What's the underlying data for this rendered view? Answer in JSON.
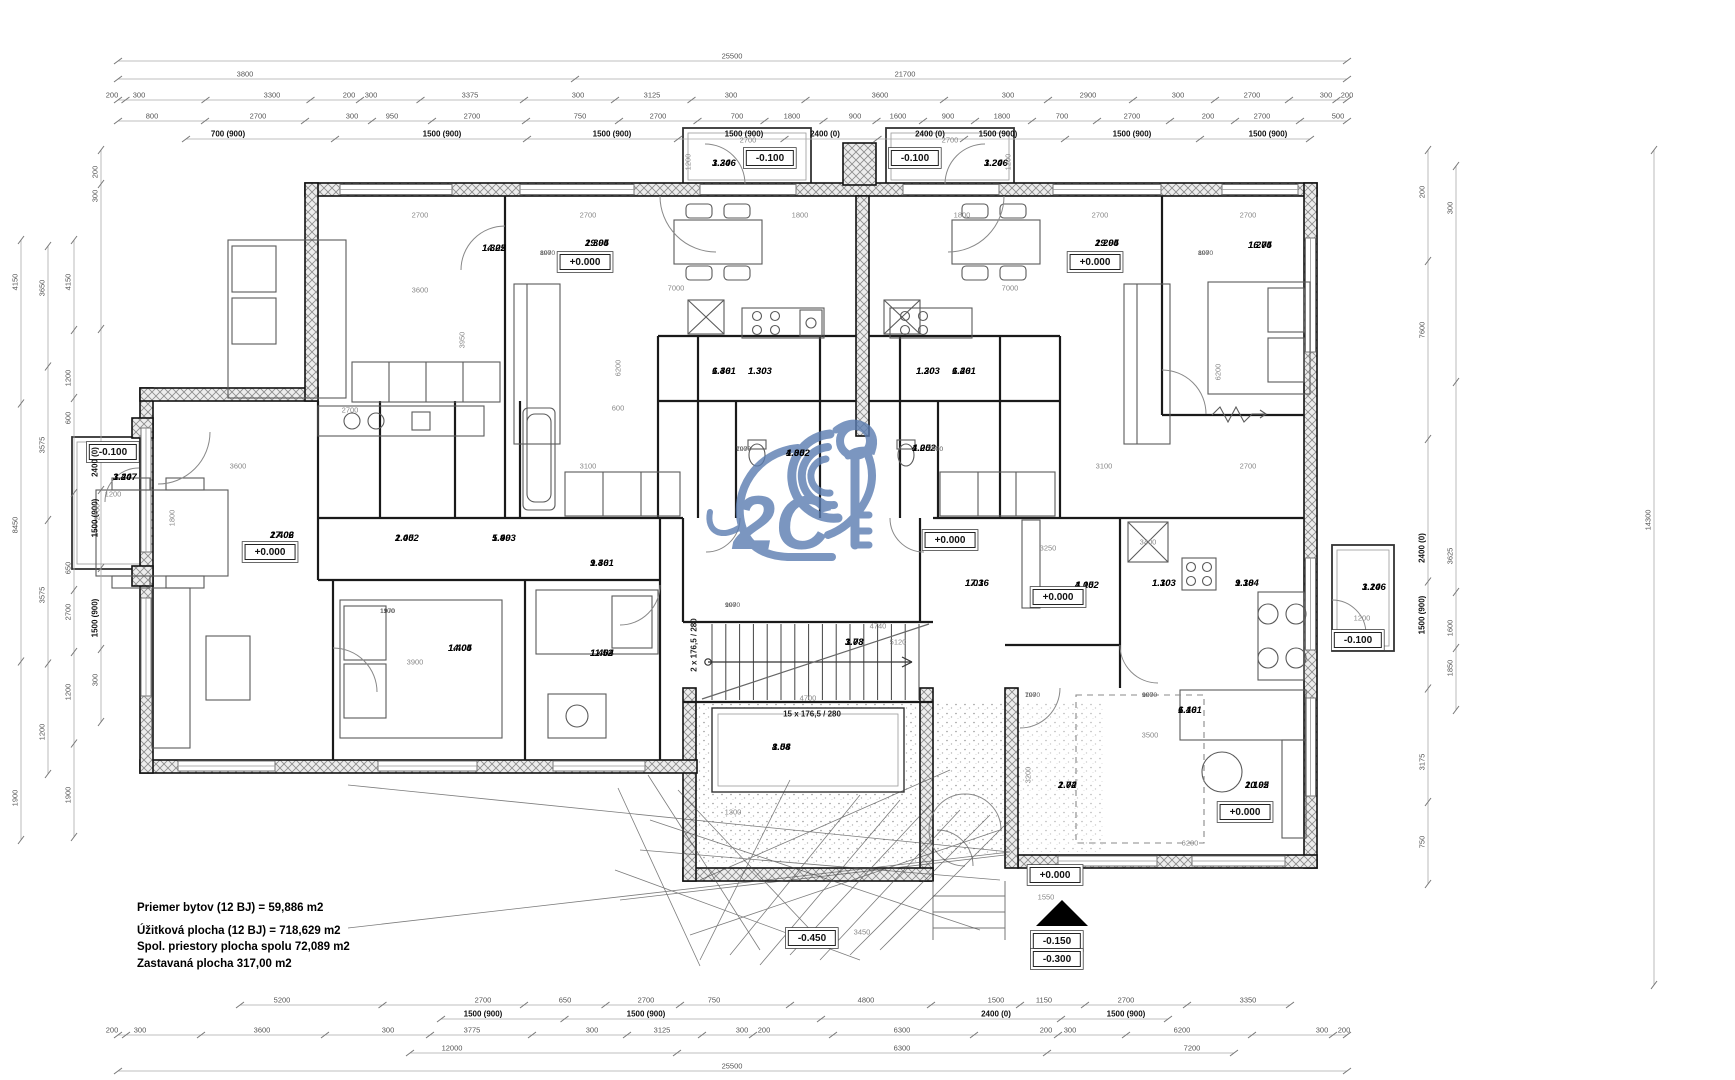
{
  "summary": {
    "l1": "Priemer bytov (12 BJ) = 59,886 m2",
    "l2": "Úžitková plocha (12 BJ) = 718,629 m2",
    "l3": "Spol. priestory plocha spolu 72,089 m2",
    "l4": "Zastavaná plocha 317,00 m2"
  },
  "watermark_text": "2C",
  "stairs": {
    "flight": "15 x 176,5 / 280",
    "entry": "2 x 176,5 / 280"
  },
  "colors": {
    "watermark": "#5b7db1",
    "wall": "#1a1a1a",
    "dim": "#555"
  },
  "rooms": [
    {
      "id": "1.305",
      "area": "14.22",
      "x": 482,
      "y": 243
    },
    {
      "id": "1.304",
      "area": "29.95",
      "x": 585,
      "y": 238
    },
    {
      "id": "1.306",
      "area": "3.24",
      "x": 712,
      "y": 158
    },
    {
      "id": "1.301",
      "area": "6.46",
      "x": 712,
      "y": 366
    },
    {
      "id": "1.303",
      "area": "1.30",
      "x": 748,
      "y": 366
    },
    {
      "id": "1.302",
      "area": "4.05",
      "x": 786,
      "y": 448
    },
    {
      "id": "1.206",
      "area": "3.24",
      "x": 984,
      "y": 158
    },
    {
      "id": "1.203",
      "area": "1.30",
      "x": 916,
      "y": 366
    },
    {
      "id": "1.201",
      "area": "6.46",
      "x": 952,
      "y": 366
    },
    {
      "id": "1.202",
      "area": "4.05",
      "x": 912,
      "y": 443
    },
    {
      "id": "1.204",
      "area": "29.95",
      "x": 1095,
      "y": 238
    },
    {
      "id": "1.205",
      "area": "16.74",
      "x": 1248,
      "y": 240
    },
    {
      "id": "1.407",
      "area": "3.24",
      "x": 113,
      "y": 472
    },
    {
      "id": "1.406",
      "area": "27.02",
      "x": 270,
      "y": 530
    },
    {
      "id": "1.402",
      "area": "2.05",
      "x": 395,
      "y": 533
    },
    {
      "id": "1.403",
      "area": "5.99",
      "x": 492,
      "y": 533
    },
    {
      "id": "1.401",
      "area": "9.36",
      "x": 590,
      "y": 558
    },
    {
      "id": "1.405",
      "area": "14.04",
      "x": 448,
      "y": 643
    },
    {
      "id": "1.404",
      "area": "11.52",
      "x": 590,
      "y": 648
    },
    {
      "id": "1.01",
      "area": "17.36",
      "x": 965,
      "y": 578
    },
    {
      "id": "1.03",
      "area": "3.78",
      "x": 845,
      "y": 637
    },
    {
      "id": "1.04",
      "area": "8.58",
      "x": 772,
      "y": 742
    },
    {
      "id": "1.02",
      "area": "2.74",
      "x": 1058,
      "y": 780
    },
    {
      "id": "1.101",
      "area": "6.46",
      "x": 1178,
      "y": 705
    },
    {
      "id": "1.102",
      "area": "4.05",
      "x": 1075,
      "y": 580
    },
    {
      "id": "1.103",
      "area": "1.30",
      "x": 1152,
      "y": 578
    },
    {
      "id": "1.104",
      "area": "9.38",
      "x": 1235,
      "y": 578
    },
    {
      "id": "1.105",
      "area": "20.92",
      "x": 1245,
      "y": 780
    },
    {
      "id": "1.106",
      "area": "3.24",
      "x": 1362,
      "y": 582
    }
  ],
  "elevations": [
    {
      "t": "+0.000",
      "x": 585,
      "y": 262
    },
    {
      "t": "+0.000",
      "x": 1095,
      "y": 262
    },
    {
      "t": "+0.000",
      "x": 270,
      "y": 552
    },
    {
      "t": "+0.000",
      "x": 950,
      "y": 540
    },
    {
      "t": "+0.000",
      "x": 1058,
      "y": 597
    },
    {
      "t": "+0.000",
      "x": 1245,
      "y": 812
    },
    {
      "t": "+0.000",
      "x": 1055,
      "y": 875
    },
    {
      "t": "-0.100",
      "x": 770,
      "y": 158
    },
    {
      "t": "-0.100",
      "x": 915,
      "y": 158
    },
    {
      "t": "-0.100",
      "x": 113,
      "y": 452
    },
    {
      "t": "-0.100",
      "x": 1358,
      "y": 640
    },
    {
      "t": "-0.450",
      "x": 812,
      "y": 938
    },
    {
      "t": "-0.150",
      "x": 1057,
      "y": 941
    },
    {
      "t": "-0.300",
      "x": 1057,
      "y": 959
    }
  ],
  "border_dims": [
    {
      "t": "25500",
      "x": 732,
      "y": 56,
      "o": "h"
    },
    {
      "t": "3800",
      "x": 245,
      "y": 74,
      "o": "h"
    },
    {
      "t": "21700",
      "x": 905,
      "y": 74,
      "o": "h"
    },
    {
      "t": "200",
      "x": 112,
      "y": 95,
      "o": "h"
    },
    {
      "t": "300",
      "x": 139,
      "y": 95,
      "o": "h"
    },
    {
      "t": "3300",
      "x": 272,
      "y": 95,
      "o": "h"
    },
    {
      "t": "200",
      "x": 349,
      "y": 95,
      "o": "h"
    },
    {
      "t": "300",
      "x": 371,
      "y": 95,
      "o": "h"
    },
    {
      "t": "3375",
      "x": 470,
      "y": 95,
      "o": "h"
    },
    {
      "t": "300",
      "x": 578,
      "y": 95,
      "o": "h"
    },
    {
      "t": "3125",
      "x": 652,
      "y": 95,
      "o": "h"
    },
    {
      "t": "300",
      "x": 731,
      "y": 95,
      "o": "h"
    },
    {
      "t": "3600",
      "x": 880,
      "y": 95,
      "o": "h"
    },
    {
      "t": "300",
      "x": 1008,
      "y": 95,
      "o": "h"
    },
    {
      "t": "2900",
      "x": 1088,
      "y": 95,
      "o": "h"
    },
    {
      "t": "300",
      "x": 1178,
      "y": 95,
      "o": "h"
    },
    {
      "t": "2700",
      "x": 1252,
      "y": 95,
      "o": "h"
    },
    {
      "t": "300",
      "x": 1326,
      "y": 95,
      "o": "h"
    },
    {
      "t": "200",
      "x": 1347,
      "y": 95,
      "o": "h"
    },
    {
      "t": "800",
      "x": 152,
      "y": 116,
      "o": "h"
    },
    {
      "t": "2700",
      "x": 258,
      "y": 116,
      "o": "h"
    },
    {
      "t": "300",
      "x": 352,
      "y": 116,
      "o": "h"
    },
    {
      "t": "950",
      "x": 392,
      "y": 116,
      "o": "h"
    },
    {
      "t": "2700",
      "x": 472,
      "y": 116,
      "o": "h"
    },
    {
      "t": "750",
      "x": 580,
      "y": 116,
      "o": "h"
    },
    {
      "t": "2700",
      "x": 658,
      "y": 116,
      "o": "h"
    },
    {
      "t": "700",
      "x": 737,
      "y": 116,
      "o": "h"
    },
    {
      "t": "1800",
      "x": 792,
      "y": 116,
      "o": "h"
    },
    {
      "t": "900",
      "x": 855,
      "y": 116,
      "o": "h"
    },
    {
      "t": "1600",
      "x": 898,
      "y": 116,
      "o": "h"
    },
    {
      "t": "900",
      "x": 948,
      "y": 116,
      "o": "h"
    },
    {
      "t": "1800",
      "x": 1002,
      "y": 116,
      "o": "h"
    },
    {
      "t": "700",
      "x": 1062,
      "y": 116,
      "o": "h"
    },
    {
      "t": "2700",
      "x": 1132,
      "y": 116,
      "o": "h"
    },
    {
      "t": "200",
      "x": 1208,
      "y": 116,
      "o": "h"
    },
    {
      "t": "2700",
      "x": 1262,
      "y": 116,
      "o": "h"
    },
    {
      "t": "500",
      "x": 1338,
      "y": 116,
      "o": "h"
    },
    {
      "t": "700 (900)",
      "x": 228,
      "y": 134,
      "o": "h",
      "b": 1
    },
    {
      "t": "1500 (900)",
      "x": 442,
      "y": 134,
      "o": "h",
      "b": 1
    },
    {
      "t": "1500 (900)",
      "x": 612,
      "y": 134,
      "o": "h",
      "b": 1
    },
    {
      "t": "1500 (900)",
      "x": 744,
      "y": 134,
      "o": "h",
      "b": 1
    },
    {
      "t": "2400 (0)",
      "x": 825,
      "y": 134,
      "o": "h",
      "b": 1
    },
    {
      "t": "2400 (0)",
      "x": 930,
      "y": 134,
      "o": "h",
      "b": 1
    },
    {
      "t": "1500 (900)",
      "x": 998,
      "y": 134,
      "o": "h",
      "b": 1
    },
    {
      "t": "1500 (900)",
      "x": 1132,
      "y": 134,
      "o": "h",
      "b": 1
    },
    {
      "t": "1500 (900)",
      "x": 1268,
      "y": 134,
      "o": "h",
      "b": 1
    },
    {
      "t": "5200",
      "x": 282,
      "y": 1000,
      "o": "h"
    },
    {
      "t": "2700",
      "x": 483,
      "y": 1000,
      "o": "h"
    },
    {
      "t": "650",
      "x": 565,
      "y": 1000,
      "o": "h"
    },
    {
      "t": "2700",
      "x": 646,
      "y": 1000,
      "o": "h"
    },
    {
      "t": "750",
      "x": 714,
      "y": 1000,
      "o": "h"
    },
    {
      "t": "4800",
      "x": 866,
      "y": 1000,
      "o": "h"
    },
    {
      "t": "1500",
      "x": 996,
      "y": 1000,
      "o": "h"
    },
    {
      "t": "1150",
      "x": 1044,
      "y": 1000,
      "o": "h"
    },
    {
      "t": "2700",
      "x": 1126,
      "y": 1000,
      "o": "h"
    },
    {
      "t": "3350",
      "x": 1248,
      "y": 1000,
      "o": "h"
    },
    {
      "t": "1500 (900)",
      "x": 483,
      "y": 1014,
      "o": "h",
      "b": 1
    },
    {
      "t": "1500 (900)",
      "x": 646,
      "y": 1014,
      "o": "h",
      "b": 1
    },
    {
      "t": "2400 (0)",
      "x": 996,
      "y": 1014,
      "o": "h",
      "b": 1
    },
    {
      "t": "1500 (900)",
      "x": 1126,
      "y": 1014,
      "o": "h",
      "b": 1
    },
    {
      "t": "200",
      "x": 112,
      "y": 1030,
      "o": "h"
    },
    {
      "t": "300",
      "x": 140,
      "y": 1030,
      "o": "h"
    },
    {
      "t": "3600",
      "x": 262,
      "y": 1030,
      "o": "h"
    },
    {
      "t": "300",
      "x": 388,
      "y": 1030,
      "o": "h"
    },
    {
      "t": "3775",
      "x": 472,
      "y": 1030,
      "o": "h"
    },
    {
      "t": "300",
      "x": 592,
      "y": 1030,
      "o": "h"
    },
    {
      "t": "3125",
      "x": 662,
      "y": 1030,
      "o": "h"
    },
    {
      "t": "300",
      "x": 742,
      "y": 1030,
      "o": "h"
    },
    {
      "t": "200",
      "x": 764,
      "y": 1030,
      "o": "h"
    },
    {
      "t": "6300",
      "x": 902,
      "y": 1030,
      "o": "h"
    },
    {
      "t": "200",
      "x": 1046,
      "y": 1030,
      "o": "h"
    },
    {
      "t": "300",
      "x": 1070,
      "y": 1030,
      "o": "h"
    },
    {
      "t": "6200",
      "x": 1182,
      "y": 1030,
      "o": "h"
    },
    {
      "t": "300",
      "x": 1322,
      "y": 1030,
      "o": "h"
    },
    {
      "t": "200",
      "x": 1344,
      "y": 1030,
      "o": "h"
    },
    {
      "t": "12000",
      "x": 452,
      "y": 1048,
      "o": "h"
    },
    {
      "t": "6300",
      "x": 902,
      "y": 1048,
      "o": "h"
    },
    {
      "t": "7200",
      "x": 1192,
      "y": 1048,
      "o": "h"
    },
    {
      "t": "25500",
      "x": 732,
      "y": 1066,
      "o": "h"
    },
    {
      "t": "4150",
      "x": 15,
      "y": 282,
      "o": "v"
    },
    {
      "t": "8450",
      "x": 15,
      "y": 525,
      "o": "v"
    },
    {
      "t": "1900",
      "x": 15,
      "y": 798,
      "o": "v"
    },
    {
      "t": "3650",
      "x": 42,
      "y": 288,
      "o": "v"
    },
    {
      "t": "3575",
      "x": 42,
      "y": 445,
      "o": "v"
    },
    {
      "t": "3575",
      "x": 42,
      "y": 595,
      "o": "v"
    },
    {
      "t": "1200",
      "x": 42,
      "y": 732,
      "o": "v"
    },
    {
      "t": "4150",
      "x": 68,
      "y": 282,
      "o": "v"
    },
    {
      "t": "1200",
      "x": 68,
      "y": 378,
      "o": "v"
    },
    {
      "t": "600",
      "x": 68,
      "y": 418,
      "o": "v"
    },
    {
      "t": "650",
      "x": 68,
      "y": 568,
      "o": "v"
    },
    {
      "t": "2700",
      "x": 68,
      "y": 612,
      "o": "v"
    },
    {
      "t": "1200",
      "x": 68,
      "y": 692,
      "o": "v"
    },
    {
      "t": "1900",
      "x": 68,
      "y": 795,
      "o": "v"
    },
    {
      "t": "200",
      "x": 95,
      "y": 172,
      "o": "v"
    },
    {
      "t": "300",
      "x": 95,
      "y": 196,
      "o": "v"
    },
    {
      "t": "2400 (0)",
      "x": 95,
      "y": 462,
      "o": "v",
      "b": 1
    },
    {
      "t": "1500 (900)",
      "x": 95,
      "y": 518,
      "o": "v",
      "b": 1
    },
    {
      "t": "1500 (900)",
      "x": 95,
      "y": 618,
      "o": "v",
      "b": 1
    },
    {
      "t": "300",
      "x": 95,
      "y": 680,
      "o": "v"
    },
    {
      "t": "200",
      "x": 1422,
      "y": 192,
      "o": "v"
    },
    {
      "t": "7600",
      "x": 1422,
      "y": 330,
      "o": "v"
    },
    {
      "t": "2400 (0)",
      "x": 1422,
      "y": 548,
      "o": "v",
      "b": 1
    },
    {
      "t": "1500 (900)",
      "x": 1422,
      "y": 615,
      "o": "v",
      "b": 1
    },
    {
      "t": "3175",
      "x": 1422,
      "y": 762,
      "o": "v"
    },
    {
      "t": "750",
      "x": 1422,
      "y": 842,
      "o": "v"
    },
    {
      "t": "300",
      "x": 1450,
      "y": 208,
      "o": "v"
    },
    {
      "t": "3625",
      "x": 1450,
      "y": 556,
      "o": "v"
    },
    {
      "t": "1600",
      "x": 1450,
      "y": 628,
      "o": "v"
    },
    {
      "t": "1850",
      "x": 1450,
      "y": 668,
      "o": "v"
    },
    {
      "t": "14300",
      "x": 1648,
      "y": 520,
      "o": "v"
    }
  ],
  "inner_dims": [
    {
      "t": "2700",
      "x": 420,
      "y": 215
    },
    {
      "t": "2700",
      "x": 588,
      "y": 215
    },
    {
      "t": "1800",
      "x": 800,
      "y": 215
    },
    {
      "t": "1800",
      "x": 962,
      "y": 215
    },
    {
      "t": "2700",
      "x": 1100,
      "y": 215
    },
    {
      "t": "2700",
      "x": 1248,
      "y": 215
    },
    {
      "t": "3600",
      "x": 420,
      "y": 290
    },
    {
      "t": "7000",
      "x": 676,
      "y": 288
    },
    {
      "t": "7000",
      "x": 1010,
      "y": 288
    },
    {
      "t": "3950",
      "x": 462,
      "y": 340,
      "rot": 1
    },
    {
      "t": "6200",
      "x": 618,
      "y": 368,
      "rot": 1
    },
    {
      "t": "6200",
      "x": 1218,
      "y": 372,
      "rot": 1
    },
    {
      "t": "3600",
      "x": 238,
      "y": 466
    },
    {
      "t": "3100",
      "x": 588,
      "y": 466
    },
    {
      "t": "3100",
      "x": 1104,
      "y": 466
    },
    {
      "t": "2700",
      "x": 1248,
      "y": 466
    },
    {
      "t": "2700",
      "x": 97,
      "y": 512,
      "rot": 1
    },
    {
      "t": "1800",
      "x": 172,
      "y": 518,
      "rot": 1
    },
    {
      "t": "2700",
      "x": 350,
      "y": 410
    },
    {
      "t": "600",
      "x": 618,
      "y": 408
    },
    {
      "t": "3400",
      "x": 1148,
      "y": 542
    },
    {
      "t": "3250",
      "x": 1048,
      "y": 548
    },
    {
      "t": "4740",
      "x": 878,
      "y": 626
    },
    {
      "t": "5120",
      "x": 898,
      "y": 642
    },
    {
      "t": "3900",
      "x": 415,
      "y": 662
    },
    {
      "t": "4700",
      "x": 808,
      "y": 698
    },
    {
      "t": "1550",
      "x": 1046,
      "y": 897
    },
    {
      "t": "3450",
      "x": 862,
      "y": 932
    },
    {
      "t": "1300",
      "x": 733,
      "y": 812
    },
    {
      "t": "3500",
      "x": 1150,
      "y": 735
    },
    {
      "t": "6200",
      "x": 1190,
      "y": 843
    },
    {
      "t": "3200",
      "x": 1028,
      "y": 775,
      "rot": 1
    },
    {
      "t": "2700",
      "x": 748,
      "y": 140
    },
    {
      "t": "1200",
      "x": 688,
      "y": 162,
      "rot": 1
    },
    {
      "t": "2700",
      "x": 950,
      "y": 140
    },
    {
      "t": "1200",
      "x": 1008,
      "y": 162,
      "rot": 1
    },
    {
      "t": "1200",
      "x": 113,
      "y": 494
    },
    {
      "t": "1200",
      "x": 1362,
      "y": 618
    }
  ],
  "door_dims": [
    {
      "w": "800",
      "h": "1970",
      "x": 540,
      "y": 250
    },
    {
      "w": "800",
      "h": "1970",
      "x": 1198,
      "y": 250
    },
    {
      "w": "700",
      "h": "1970",
      "x": 736,
      "y": 446
    },
    {
      "w": "700",
      "h": "1970",
      "x": 928,
      "y": 446
    },
    {
      "w": "900",
      "h": "1970",
      "x": 725,
      "y": 602
    },
    {
      "w": "1100",
      "h": "1970",
      "x": 380,
      "y": 608
    },
    {
      "w": "700",
      "h": "1970",
      "x": 1025,
      "y": 692
    },
    {
      "w": "900",
      "h": "1970",
      "x": 1142,
      "y": 692
    }
  ]
}
